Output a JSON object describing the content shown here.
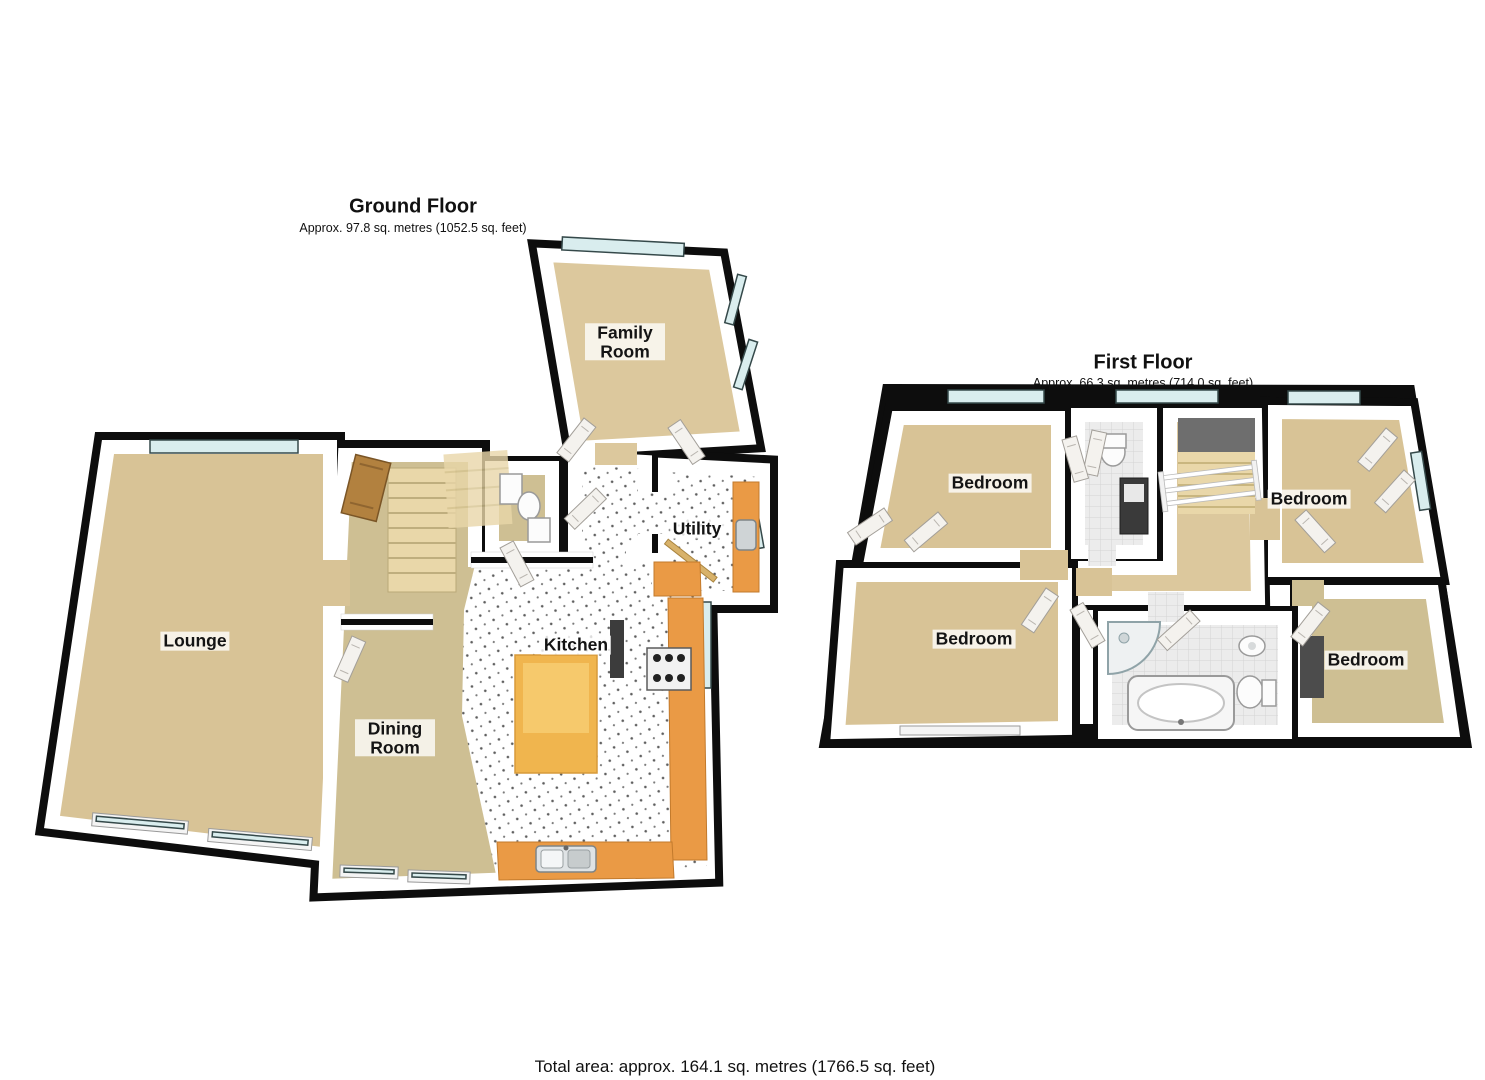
{
  "ground_floor": {
    "title": "Ground Floor",
    "subtitle": "Approx. 97.8 sq. metres (1052.5 sq. feet)",
    "rooms": {
      "family_room": "Family Room",
      "lounge": "Lounge",
      "utility": "Utility",
      "kitchen": "Kitchen",
      "dining_room": "Dining Room"
    }
  },
  "first_floor": {
    "title": "First Floor",
    "subtitle": "Approx. 66.3 sq. metres (714.0 sq. feet)",
    "rooms": {
      "bedroom_top_left": "Bedroom",
      "bedroom_top_right": "Bedroom",
      "bedroom_bottom_left": "Bedroom",
      "bedroom_bottom_right": "Bedroom"
    }
  },
  "footer": {
    "total_area": "Total area: approx. 164.1 sq. metres (1766.5 sq. feet)"
  },
  "colors": {
    "wall": "#0d0d0d",
    "carpet": "#d8c396",
    "carpet_dark": "#cebf93",
    "carpet_warm": "#dcc89d",
    "counter": "#ea9a45",
    "island": "#f0b54e",
    "island_top": "#f7cd72",
    "glass": "#d9edee",
    "stairs": "#e9d7a9",
    "wood": "#b2813f",
    "gray_floor": "#e9e9e9",
    "stairwell": "#6e6e6e"
  }
}
